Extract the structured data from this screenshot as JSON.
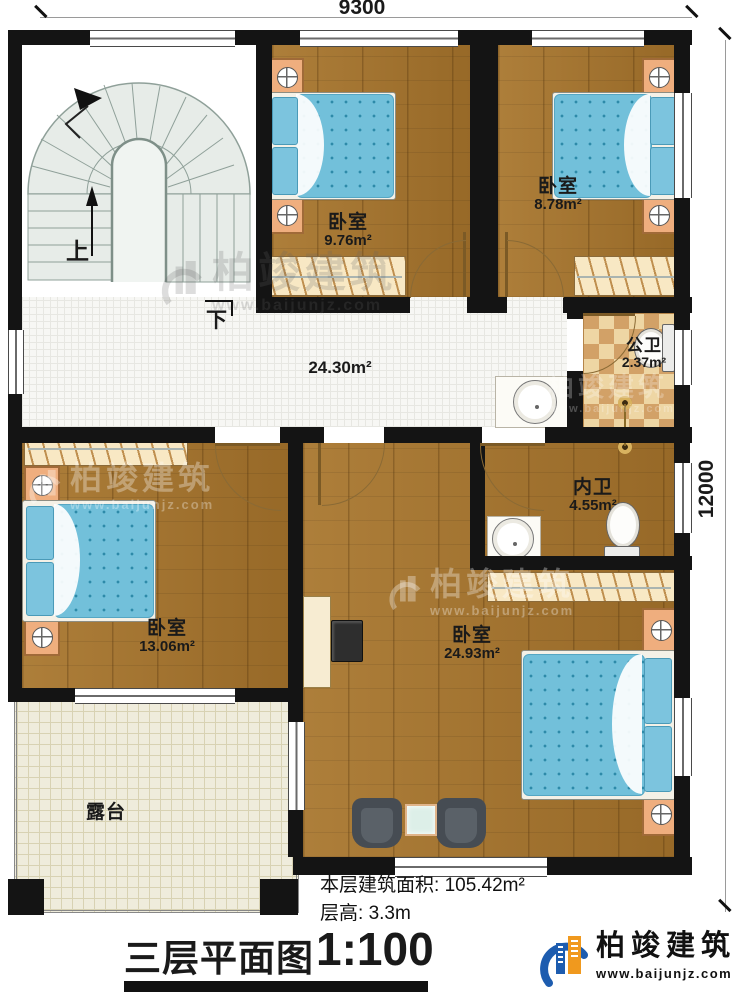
{
  "dimensions": {
    "width_top": "9300",
    "height_right": "12000"
  },
  "stairs": {
    "up": "上",
    "down": "下"
  },
  "rooms": {
    "bed_tl": {
      "name": "卧室",
      "area": "9.76m²"
    },
    "bed_tr": {
      "name": "卧室",
      "area": "8.78m²"
    },
    "hall": {
      "area": "24.30m²"
    },
    "pub_bath": {
      "name": "公卫",
      "area": "2.37m²"
    },
    "inner_bath": {
      "name": "内卫",
      "area": "4.55m²"
    },
    "bed_left": {
      "name": "卧室",
      "area": "13.06m²"
    },
    "bed_master": {
      "name": "卧室",
      "area": "24.93m²"
    },
    "terrace": {
      "name": "露台"
    }
  },
  "footer": {
    "area_label": "本层建筑面积:",
    "area_value": "105.42m²",
    "height_label": "层高:",
    "height_value": "3.3m",
    "title": "三层平面图",
    "scale": "1:100"
  },
  "brand": {
    "name": "柏竣建筑",
    "site": "www.baijunjz.com"
  }
}
